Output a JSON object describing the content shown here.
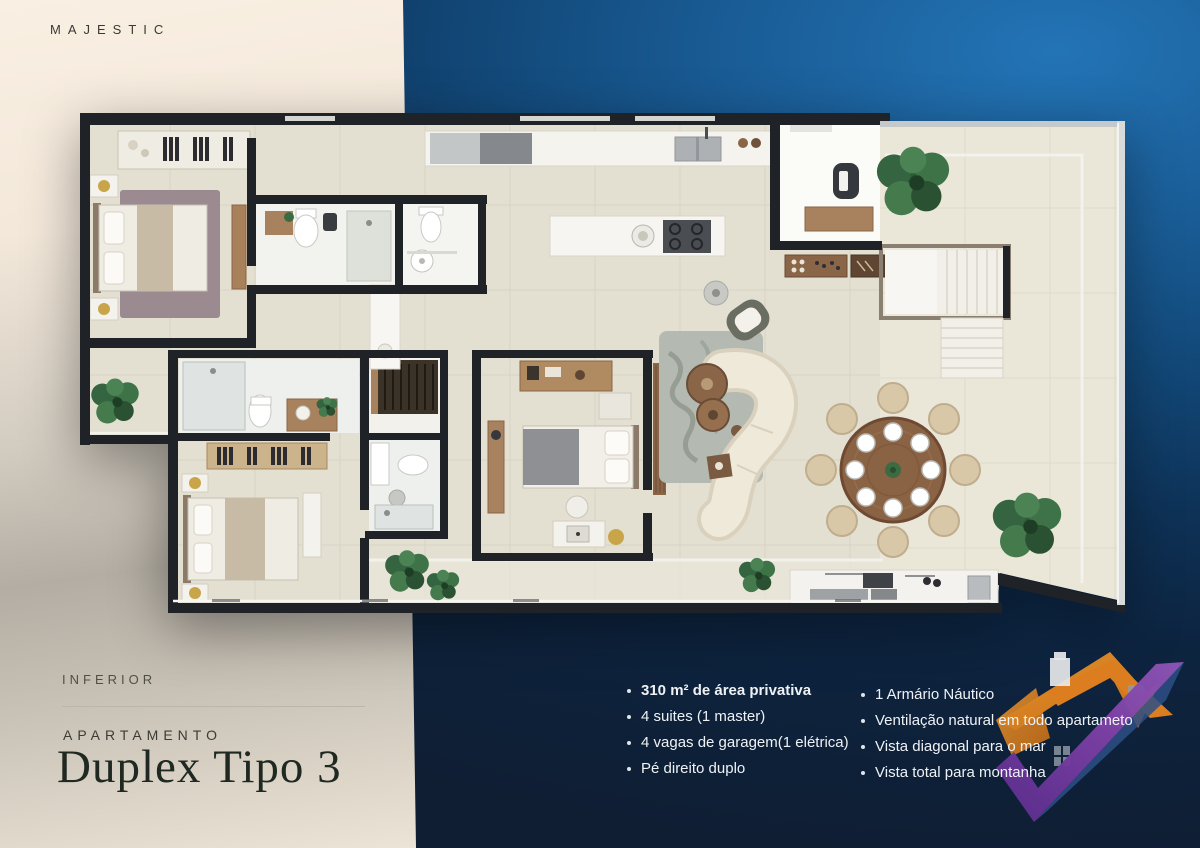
{
  "brand": {
    "name": "MAJESTIC"
  },
  "panel": {
    "level": "INFERIOR",
    "category": "APARTAMENTO",
    "title": "Duplex Tipo 3"
  },
  "features": {
    "left": [
      {
        "text": "310 m² de área privativa",
        "bold": true
      },
      {
        "text": "4 suites (1 master)",
        "bold": false
      },
      {
        "text": "4 vagas de garagem(1 elétrica)",
        "bold": false
      },
      {
        "text": "Pé direito duplo",
        "bold": false
      }
    ],
    "right": [
      {
        "text": "1 Armário Náutico",
        "bold": false
      },
      {
        "text": "Ventilação natural em todo apartameto",
        "bold": false
      },
      {
        "text": "Vista diagonal para o mar",
        "bold": false
      },
      {
        "text": "Vista total para montanha",
        "bold": false
      }
    ]
  },
  "colors": {
    "cream_panel": "#f7ecdf",
    "navy_light": "#2374b6",
    "navy_dark": "#0f1e33",
    "wall": "#1f2227",
    "floor_main": "#e3e0d2",
    "floor_terrace": "#eae6d8",
    "wood": "#8a6548",
    "logo_orange": "#e8821e",
    "logo_purple": "#7b3fa4",
    "text_light": "#eef2f5",
    "text_dark": "#1f2922",
    "gold_accent": "#c9a54a"
  },
  "floor_plan": {
    "alt": "Top-down rendered floor plan of the lower level of Duplex Tipo 3"
  }
}
